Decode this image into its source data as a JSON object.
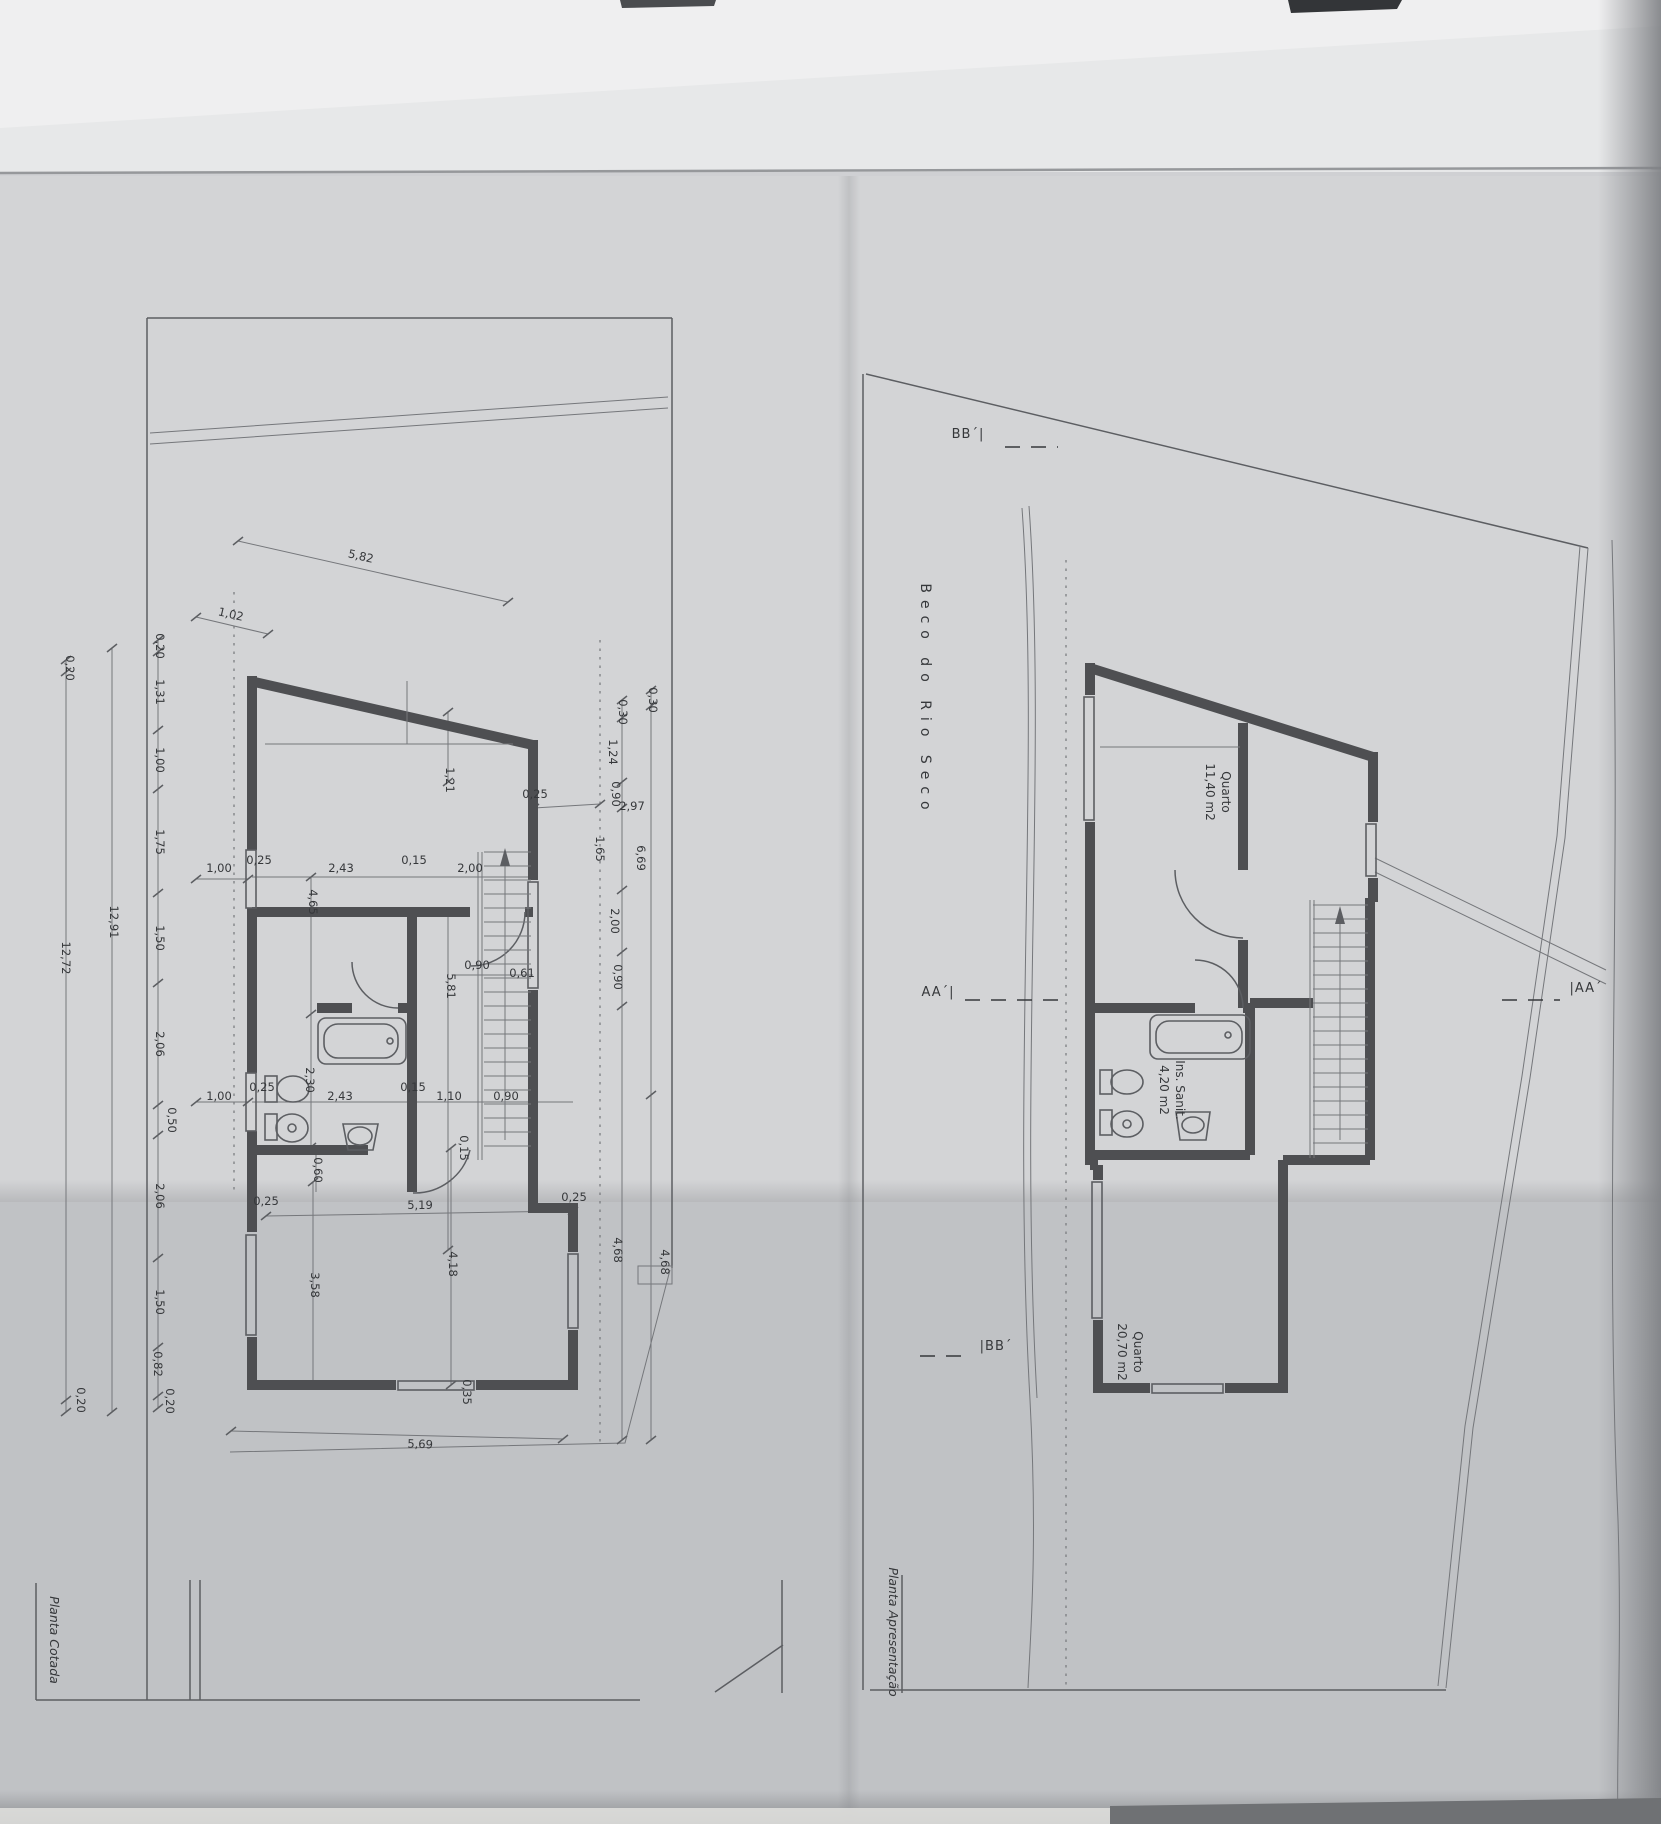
{
  "colors": {
    "paper_top": "#e7e8e9",
    "paper_mid": "#d3d4d6",
    "paper_low": "#c0c2c5",
    "ink": "#36383b",
    "wall_gray": "#4e4f52",
    "edge_dark": "#86888c"
  },
  "sheet": {
    "street_name": "Beco do Rio Seco",
    "left_plan_title": "Planta Cotada",
    "right_plan_title": "Planta Apresentação"
  },
  "right_plan_rooms": [
    {
      "name": "Quarto",
      "area": "11,40 m2",
      "x": 1214,
      "y": 792
    },
    {
      "name": "Ins. Sanit.",
      "area": "4,20 m2",
      "x": 1168,
      "y": 1090
    },
    {
      "name": "Quarto",
      "area": "20,70 m2",
      "x": 1126,
      "y": 1352
    }
  ],
  "section_markers": [
    {
      "t": "AA´|",
      "x": 938,
      "y": 996
    },
    {
      "t": "|AA´",
      "x": 1586,
      "y": 992
    },
    {
      "t": "BB´|",
      "x": 968,
      "y": 438
    },
    {
      "t": "|BB´",
      "x": 996,
      "y": 1350
    }
  ],
  "left_plan_dimensions": [
    {
      "t": "0,20",
      "x": 66,
      "y": 668,
      "r": 90
    },
    {
      "t": "12,72",
      "x": 62,
      "y": 958,
      "r": 90
    },
    {
      "t": "0,20",
      "x": 77,
      "y": 1400,
      "r": 90
    },
    {
      "t": "12,91",
      "x": 110,
      "y": 922,
      "r": 90
    },
    {
      "t": "0,20",
      "x": 156,
      "y": 646,
      "r": 90
    },
    {
      "t": "1,31",
      "x": 156,
      "y": 692,
      "r": 90
    },
    {
      "t": "1,00",
      "x": 156,
      "y": 760,
      "r": 90
    },
    {
      "t": "1,75",
      "x": 156,
      "y": 842,
      "r": 90
    },
    {
      "t": "1,50",
      "x": 156,
      "y": 938,
      "r": 90
    },
    {
      "t": "2,06",
      "x": 156,
      "y": 1044,
      "r": 90
    },
    {
      "t": "0,50",
      "x": 168,
      "y": 1120,
      "r": 90
    },
    {
      "t": "2,06",
      "x": 156,
      "y": 1196,
      "r": 90
    },
    {
      "t": "1,50",
      "x": 156,
      "y": 1302,
      "r": 90
    },
    {
      "t": "0,82",
      "x": 154,
      "y": 1364,
      "r": 90
    },
    {
      "t": "0,20",
      "x": 166,
      "y": 1401,
      "r": 90
    },
    {
      "t": "1,02",
      "x": 230,
      "y": 618,
      "r": 13
    },
    {
      "t": "5,82",
      "x": 360,
      "y": 560,
      "r": 13
    },
    {
      "t": "1,00",
      "x": 219,
      "y": 872,
      "r": 0
    },
    {
      "t": "0,25",
      "x": 259,
      "y": 864,
      "r": 0
    },
    {
      "t": "2,43",
      "x": 341,
      "y": 872,
      "r": 0
    },
    {
      "t": "0,15",
      "x": 414,
      "y": 864,
      "r": 0
    },
    {
      "t": "2,00",
      "x": 470,
      "y": 872,
      "r": 0
    },
    {
      "t": "0,25",
      "x": 535,
      "y": 798,
      "r": 0
    },
    {
      "t": "2,97",
      "x": 632,
      "y": 810,
      "r": 0
    },
    {
      "t": "4,65",
      "x": 309,
      "y": 902,
      "r": 90
    },
    {
      "t": "1,21",
      "x": 446,
      "y": 780,
      "r": 90
    },
    {
      "t": "5,81",
      "x": 447,
      "y": 986,
      "r": 90
    },
    {
      "t": "0,90",
      "x": 477,
      "y": 969,
      "r": 0
    },
    {
      "t": "0,61",
      "x": 522,
      "y": 977,
      "r": 0
    },
    {
      "t": "2,30",
      "x": 306,
      "y": 1080,
      "r": 90
    },
    {
      "t": "1,00",
      "x": 219,
      "y": 1100,
      "r": 0
    },
    {
      "t": "0,25",
      "x": 262,
      "y": 1091,
      "r": 0
    },
    {
      "t": "2,43",
      "x": 340,
      "y": 1100,
      "r": 0
    },
    {
      "t": "0,15",
      "x": 413,
      "y": 1091,
      "r": 0
    },
    {
      "t": "1,10",
      "x": 449,
      "y": 1100,
      "r": 0
    },
    {
      "t": "0,90",
      "x": 506,
      "y": 1100,
      "r": 0
    },
    {
      "t": "0,15",
      "x": 460,
      "y": 1148,
      "r": 90
    },
    {
      "t": "0,60",
      "x": 314,
      "y": 1170,
      "r": 90
    },
    {
      "t": "0,25",
      "x": 266,
      "y": 1205,
      "r": 0
    },
    {
      "t": "5,19",
      "x": 420,
      "y": 1209,
      "r": 0
    },
    {
      "t": "0,25",
      "x": 574,
      "y": 1201,
      "r": 0
    },
    {
      "t": "3,58",
      "x": 311,
      "y": 1285,
      "r": 90
    },
    {
      "t": "4,18",
      "x": 449,
      "y": 1264,
      "r": 90
    },
    {
      "t": "0,35",
      "x": 463,
      "y": 1392,
      "r": 90
    },
    {
      "t": "5,69",
      "x": 420,
      "y": 1448,
      "r": 2
    },
    {
      "t": "0,30",
      "x": 619,
      "y": 712,
      "r": 90
    },
    {
      "t": "1,24",
      "x": 609,
      "y": 752,
      "r": 90
    },
    {
      "t": "0,90",
      "x": 612,
      "y": 794,
      "r": 90
    },
    {
      "t": "1,65",
      "x": 596,
      "y": 849,
      "r": 90
    },
    {
      "t": "2,00",
      "x": 611,
      "y": 921,
      "r": 90
    },
    {
      "t": "0,90",
      "x": 614,
      "y": 977,
      "r": 90
    },
    {
      "t": "4,68",
      "x": 614,
      "y": 1250,
      "r": 90
    },
    {
      "t": "0,30",
      "x": 649,
      "y": 700,
      "r": 90
    },
    {
      "t": "6,69",
      "x": 637,
      "y": 858,
      "r": 90
    },
    {
      "t": "4,68",
      "x": 661,
      "y": 1262,
      "r": 90
    }
  ]
}
